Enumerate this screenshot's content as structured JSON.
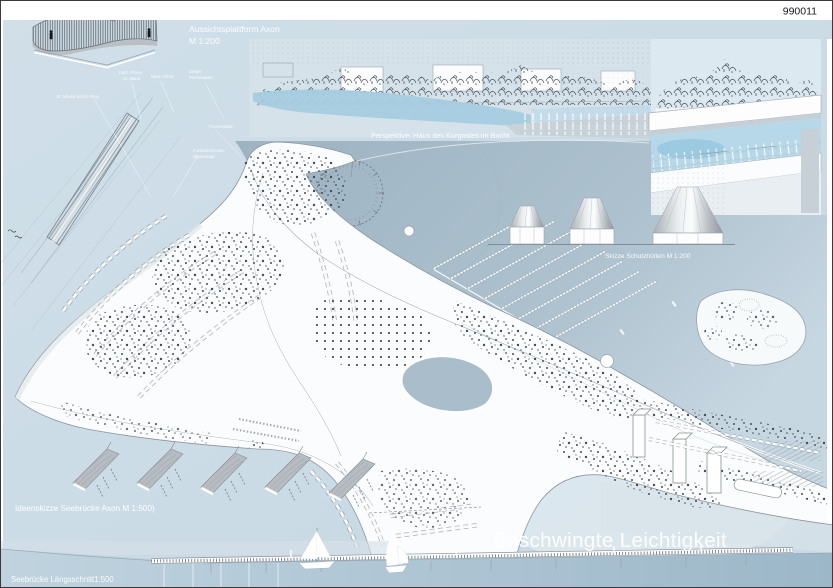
{
  "board": {
    "project_number": "990011",
    "main_title": "Beschwingte Leichtigkeit"
  },
  "labels": {
    "axon_platform_line1": "Aussichtsplattform Axon",
    "axon_platform_line2": "M 1:200",
    "perspective_caption": "Perspektive: Haus des Kurgastes im Bucht",
    "huts_caption": "Skizze Schutzhütten M 1:200",
    "pier_axon_caption": "Ideenskizze Seebrücke Axon M 1:500)",
    "pier_section_caption": "Seebrücke Längsschnitt1:500"
  },
  "plan_annotations": [
    {
      "line1": "Kath. Pfarre",
      "line2": "St. Maria"
    },
    {
      "line1": "Neue Fähre",
      "line2": ""
    },
    {
      "line1": "Berger",
      "line2": "Promenaden"
    },
    {
      "line1": "St. Nikolai Kirche Ring",
      "line2": ""
    },
    {
      "line1": "Promenaden",
      "line2": ""
    },
    {
      "line1": "Funktionsknoten",
      "line2": "Wasserbad"
    }
  ],
  "colors": {
    "board_bg": "#ccdce6",
    "bay_water": "#a8bdcb",
    "pool_blue": "#a6cbe0",
    "section_water": "#b3c9d7",
    "tree_ink": "#3f474f",
    "title_white": "#ffffff"
  }
}
